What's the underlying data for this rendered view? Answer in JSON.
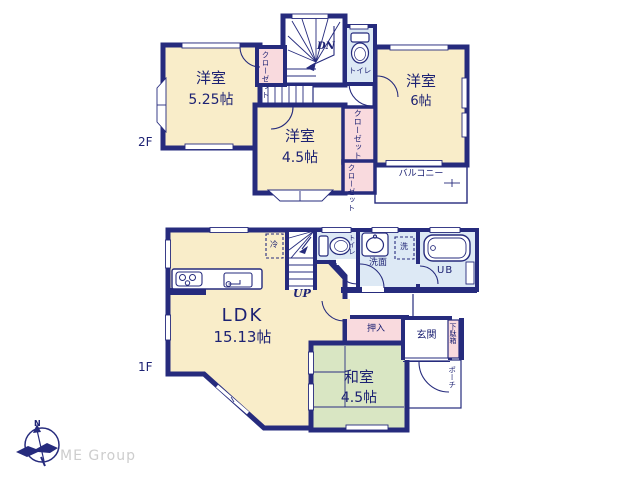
{
  "branding": {
    "company": "ME Group",
    "compass_north": "N"
  },
  "floor2": {
    "label": "2F",
    "stairs": "DN",
    "rooms": {
      "west_bedroom": {
        "name": "洋室",
        "size": "5.25帖"
      },
      "center_bedroom": {
        "name": "洋室",
        "size": "4.5帖"
      },
      "east_bedroom": {
        "name": "洋室",
        "size": "6帖"
      },
      "toilet": "トイレ",
      "closet_hall": "クローゼット",
      "closet_mid": "クローゼット",
      "closet_small": "クローゼット",
      "balcony": "バルコニー"
    }
  },
  "floor1": {
    "label": "1F",
    "stairs": "UP",
    "rooms": {
      "ldk": {
        "name": "LDK",
        "size": "15.13帖"
      },
      "tatami": {
        "name": "和室",
        "size": "4.5帖"
      },
      "toilet": "トイレ",
      "washroom": "洗面",
      "laundry": "洗",
      "fridge": "冷",
      "bath": "UB",
      "closet": "押入",
      "entrance": "玄関",
      "shoe_cabinet": "下駄箱",
      "porch": "ポーチ"
    }
  },
  "colors": {
    "wall": "#262b7d",
    "room": "#f9edc9",
    "closet": "#f9dade",
    "wet_area": "#dde9f5",
    "tatami_room": "#d9e6c3",
    "text": "#1d2273",
    "brand_text": "#cdcdcd"
  }
}
